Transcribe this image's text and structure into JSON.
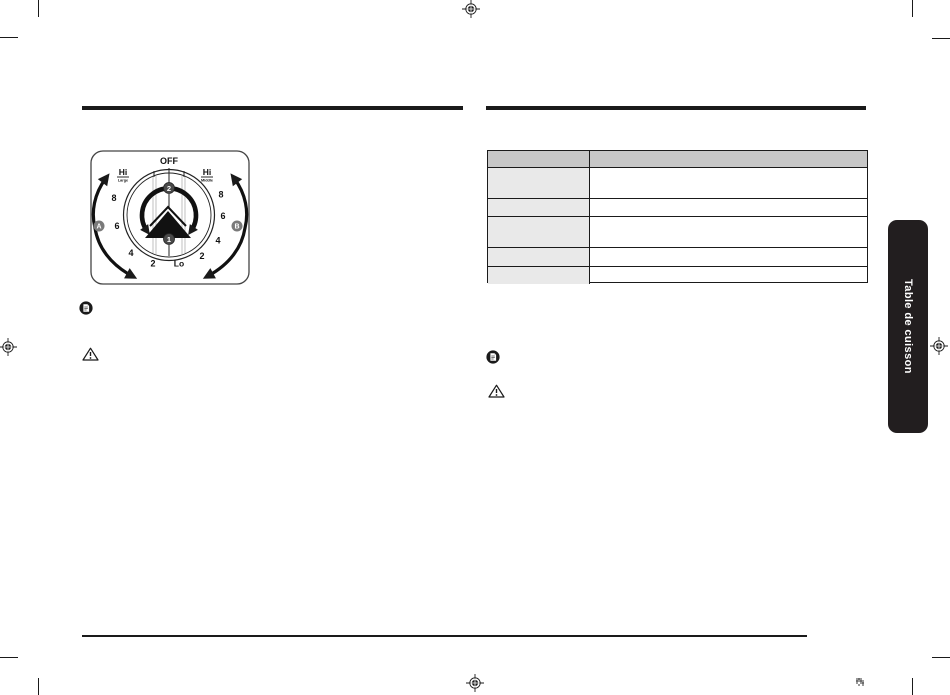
{
  "colors": {
    "ink": "#1a1a1a",
    "table_header_bg": "#c7c7c7",
    "table_label_bg": "#e9e9e9",
    "tab_bg": "#221e1f",
    "badge_bg": "#7a7a7a",
    "step_badge_bg": "#4a4a4a"
  },
  "side_tab": {
    "label": "Table de cuisson"
  },
  "left_column": {
    "knob_diagram": {
      "off": "OFF",
      "hi_left": "Hi",
      "hi_left_sub": "Large",
      "hi_right": "Hi",
      "hi_right_sub": "Middle",
      "lo": "Lo",
      "scale_left": [
        "8",
        "6",
        "4",
        "2"
      ],
      "scale_right": [
        "8",
        "6",
        "4",
        "2"
      ],
      "step1": "1",
      "step2": "2",
      "burner_a": "A",
      "burner_b": "B"
    }
  },
  "right_column": {
    "table": {
      "header": [
        "",
        ""
      ],
      "rows": [
        [
          "",
          ""
        ],
        [
          "",
          ""
        ],
        [
          "",
          ""
        ],
        [
          "",
          ""
        ],
        [
          "",
          ""
        ]
      ]
    }
  }
}
